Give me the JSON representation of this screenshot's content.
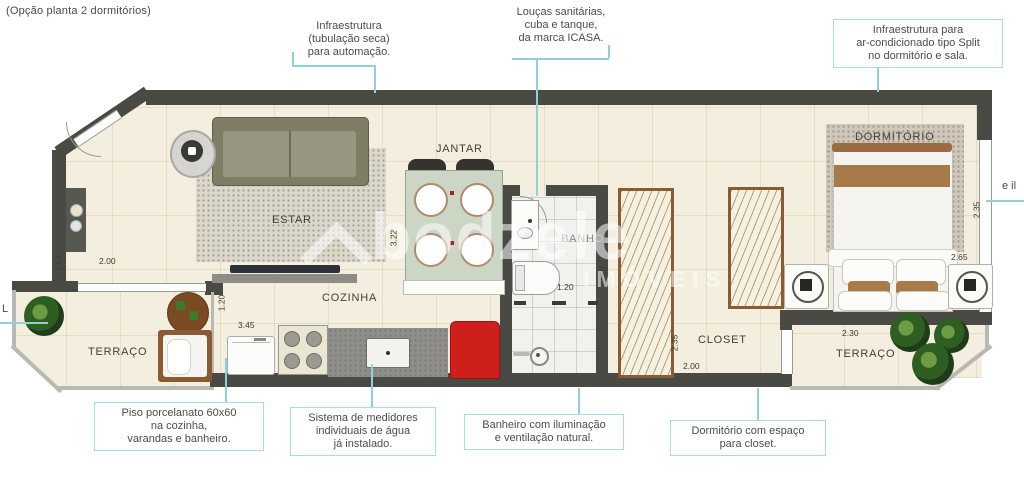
{
  "title": "(Opção planta 2 dormitórios)",
  "watermark": {
    "brand": "bodzele",
    "sub": "IMÓVEIS",
    "logo": "chevron-logo"
  },
  "callouts": {
    "automacao": "Infraestrutura\n(tubulação seca)\npara automação.",
    "loucas": "Louças sanitárias,\ncuba e tanque,\nda marca ICASA.",
    "split": "Infraestrutura para\nar-condicionado tipo Split\nno dormitório e sala.",
    "piso": "Piso porcelanato 60x60\nna cozinha,\nvarandas e banheiro.",
    "medidores": "Sistema de medidores\nindividuais de água\njá instalado.",
    "banheiro": "Banheiro com iluminação\ne ventilação natural.",
    "dormitorio_closet": "Dormitório com espaço\npara closet.",
    "left_partial": "L",
    "right_partial": "e il"
  },
  "rooms": {
    "estar": "ESTAR",
    "jantar": "JANTAR",
    "cozinha": "COZINHA",
    "banho": "BANHO",
    "dormitorio": "DORMITÓRIO",
    "closet": "CLOSET",
    "terraco_esq": "TERRAÇO",
    "terraco_dir": "TERRAÇO"
  },
  "dimensions": {
    "estar_altura": "1.54",
    "estar_largura": "2.00",
    "terraco_esq_altura": "1.20",
    "cozinha_largura": "3.45",
    "jantar_altura": "3.22",
    "banho_largura": "1.20",
    "banho_altura": "2.20",
    "closet_altura": "2.35",
    "closet_largura": "2.00",
    "dormitorio_altura": "2.35",
    "dormitorio_largura": "2.65",
    "terraco_dir_largura": "2.30"
  },
  "colors": {
    "wall": "#4a4a45",
    "floor": "#f3eedd",
    "callout_accent": "#8fd0db",
    "red_cabinet": "#cf1f1c",
    "wardrobe": "#8a5a32",
    "sofa": "#84826b"
  }
}
